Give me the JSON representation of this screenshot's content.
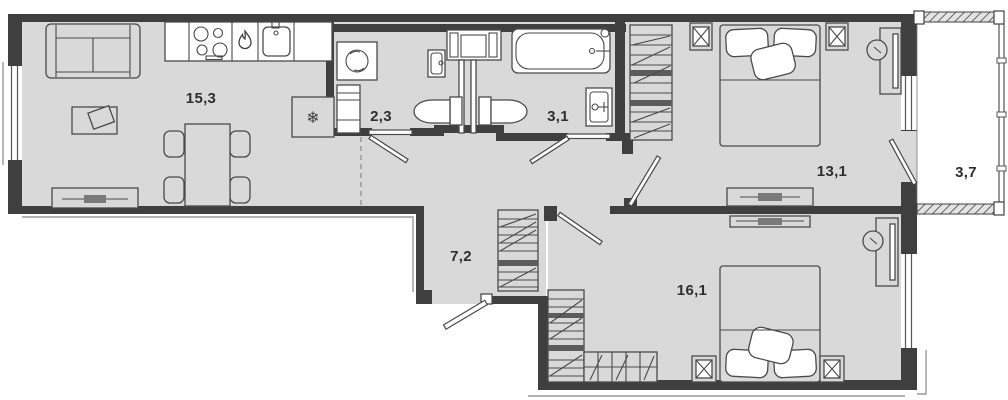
{
  "rooms": [
    {
      "id": "living-kitchen",
      "area": "15,3"
    },
    {
      "id": "bathroom-small",
      "area": "2,3"
    },
    {
      "id": "bathroom-large",
      "area": "3,1"
    },
    {
      "id": "bedroom-1",
      "area": "13,1"
    },
    {
      "id": "balcony",
      "area": "3,7"
    },
    {
      "id": "hallway",
      "area": "7,2"
    },
    {
      "id": "bedroom-2",
      "area": "16,1"
    }
  ],
  "icons": {
    "fridge_snowflake": "❄"
  },
  "colors": {
    "floor": "#d9d9d9",
    "wall": "#3f3f3f",
    "fixture_fill": "#ffffff",
    "furniture_outline": "#4a4a4a",
    "dark_bar": "#5c5c5c",
    "label_text": "#2f2f2f",
    "exterior_thin_line": "#999999"
  }
}
